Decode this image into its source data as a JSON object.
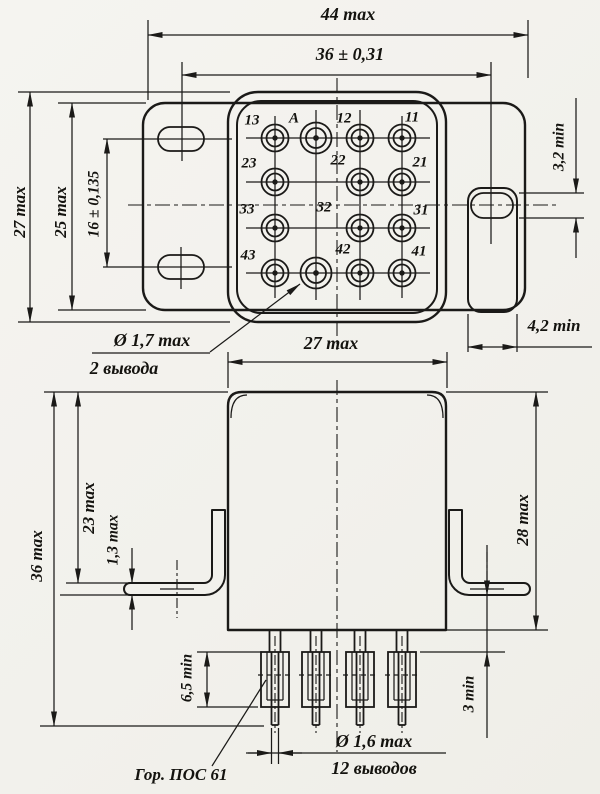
{
  "top_view": {
    "dim_overall_width": "44 max",
    "dim_mount_span": "36 ± 0,31",
    "dim_overall_height": "27 max",
    "dim_flange_height": "25 max",
    "dim_slot_pitch": "16 ± 0,135",
    "dim_slot_width": "3,2 min",
    "dim_tab_width": "4,2 min",
    "pin_labels": [
      "13",
      "A",
      "12",
      "11",
      "23",
      "22",
      "21",
      "33",
      "32",
      "31",
      "43",
      "42",
      "41"
    ],
    "pin_callout": {
      "diameter": "Ø 1,7 max",
      "count": "2 вывода"
    }
  },
  "side_view": {
    "dim_body_width": "27 max",
    "dim_overall_height": "36 max",
    "dim_bracket_drop": "23 max",
    "dim_foot_thickness": "1,3 max",
    "dim_body_height": "28 max",
    "dim_sleeve_min": "6,5 min",
    "dim_clearance_min": "3 min",
    "pin_callout": {
      "diameter": "Ø 1,6 max",
      "count": "12 выводов"
    },
    "solder_note": "Гор. ПОС 61"
  }
}
